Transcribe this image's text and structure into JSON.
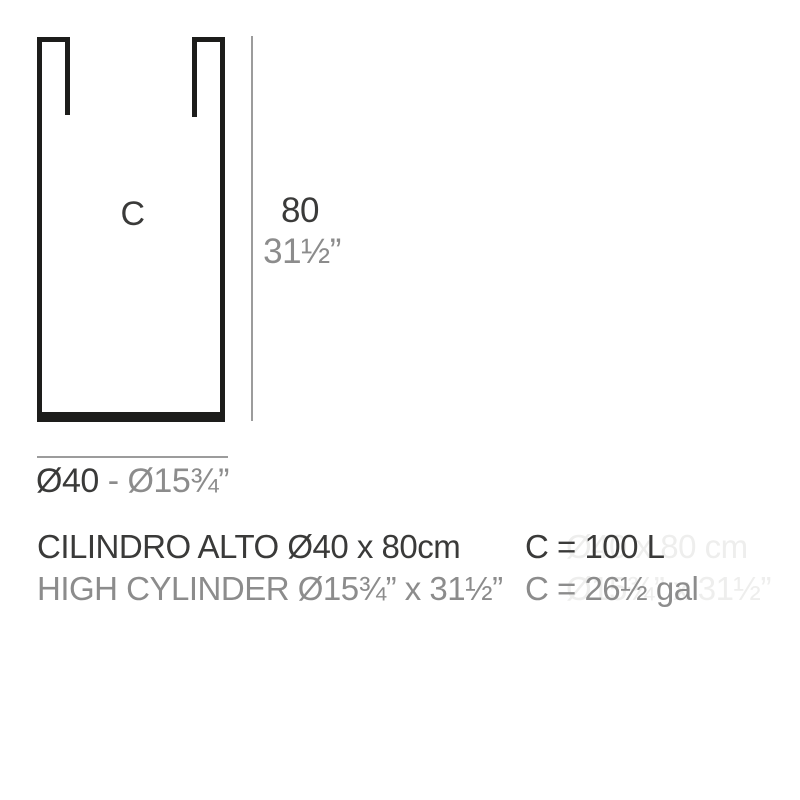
{
  "diagram": {
    "model_letter": "C",
    "height_cm": "80",
    "height_in": "31½”",
    "diameter_cm": "Ø40",
    "diameter_sep": " - ",
    "diameter_in": "Ø15¾”"
  },
  "specs": {
    "name_metric": "CILINDRO ALTO Ø40 x 80cm",
    "name_imperial": "HIGH CYLINDER Ø15¾” x 31½”",
    "capacity_liters": "C = 100 L",
    "capacity_gallons": "C = 26½ gal",
    "ghost_metric": "Ø40 x 80 cm",
    "ghost_imperial": "Ø15¾” x 31½”"
  },
  "colors": {
    "outline_black": "#1d1d1b",
    "dimension_gray": "#9c9c9c",
    "text_dark": "#3a3a39",
    "text_gray": "#8c8c8c",
    "ghost_text": "#eeeeed",
    "background": "#ffffff"
  }
}
